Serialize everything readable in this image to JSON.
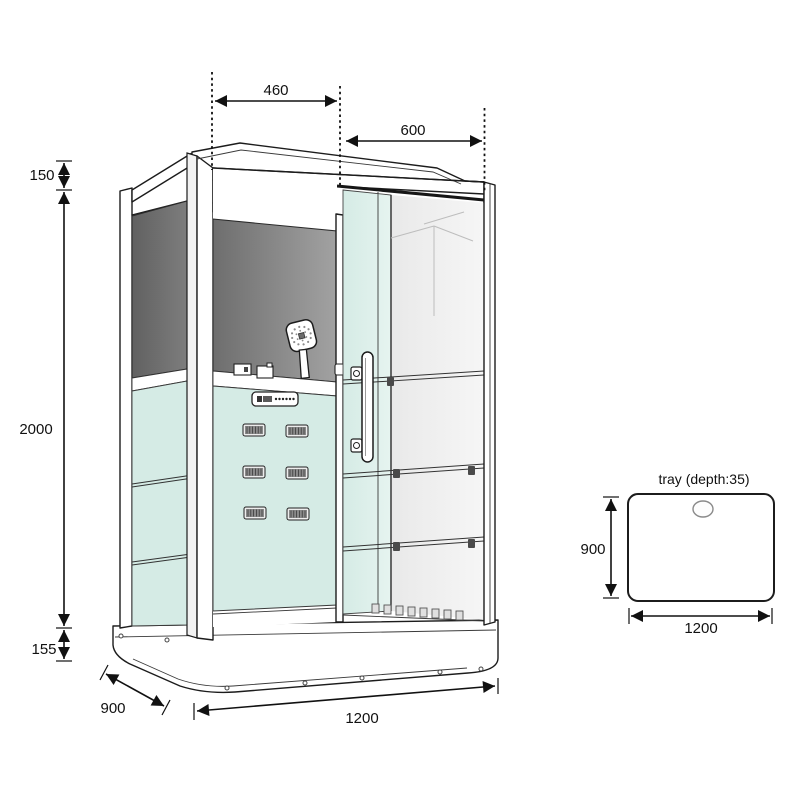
{
  "drawing": {
    "title": "steam shower cabin technical drawing",
    "dims": {
      "top_left_width": "460",
      "top_right_width": "600",
      "upper_height": "150",
      "body_height": "2000",
      "base_height": "155",
      "depth": "900",
      "width": "1200"
    },
    "tray": {
      "title": "tray (depth:35)",
      "depth": "900",
      "width": "1200"
    },
    "colors": {
      "line": "#1c1c1c",
      "back_panel_dark": "#6e6e6e",
      "back_panel_light": "#a2a2a2",
      "side_panel_dark": "#616161",
      "side_panel_light": "#7d7d7d",
      "glass_mint": "#d5ebe5",
      "glass_mint_light": "#e6f4f0",
      "interior_light": "#e9e9e9",
      "interior_lighter": "#f6f6f6",
      "jet_face": "#8a8a8a"
    }
  }
}
